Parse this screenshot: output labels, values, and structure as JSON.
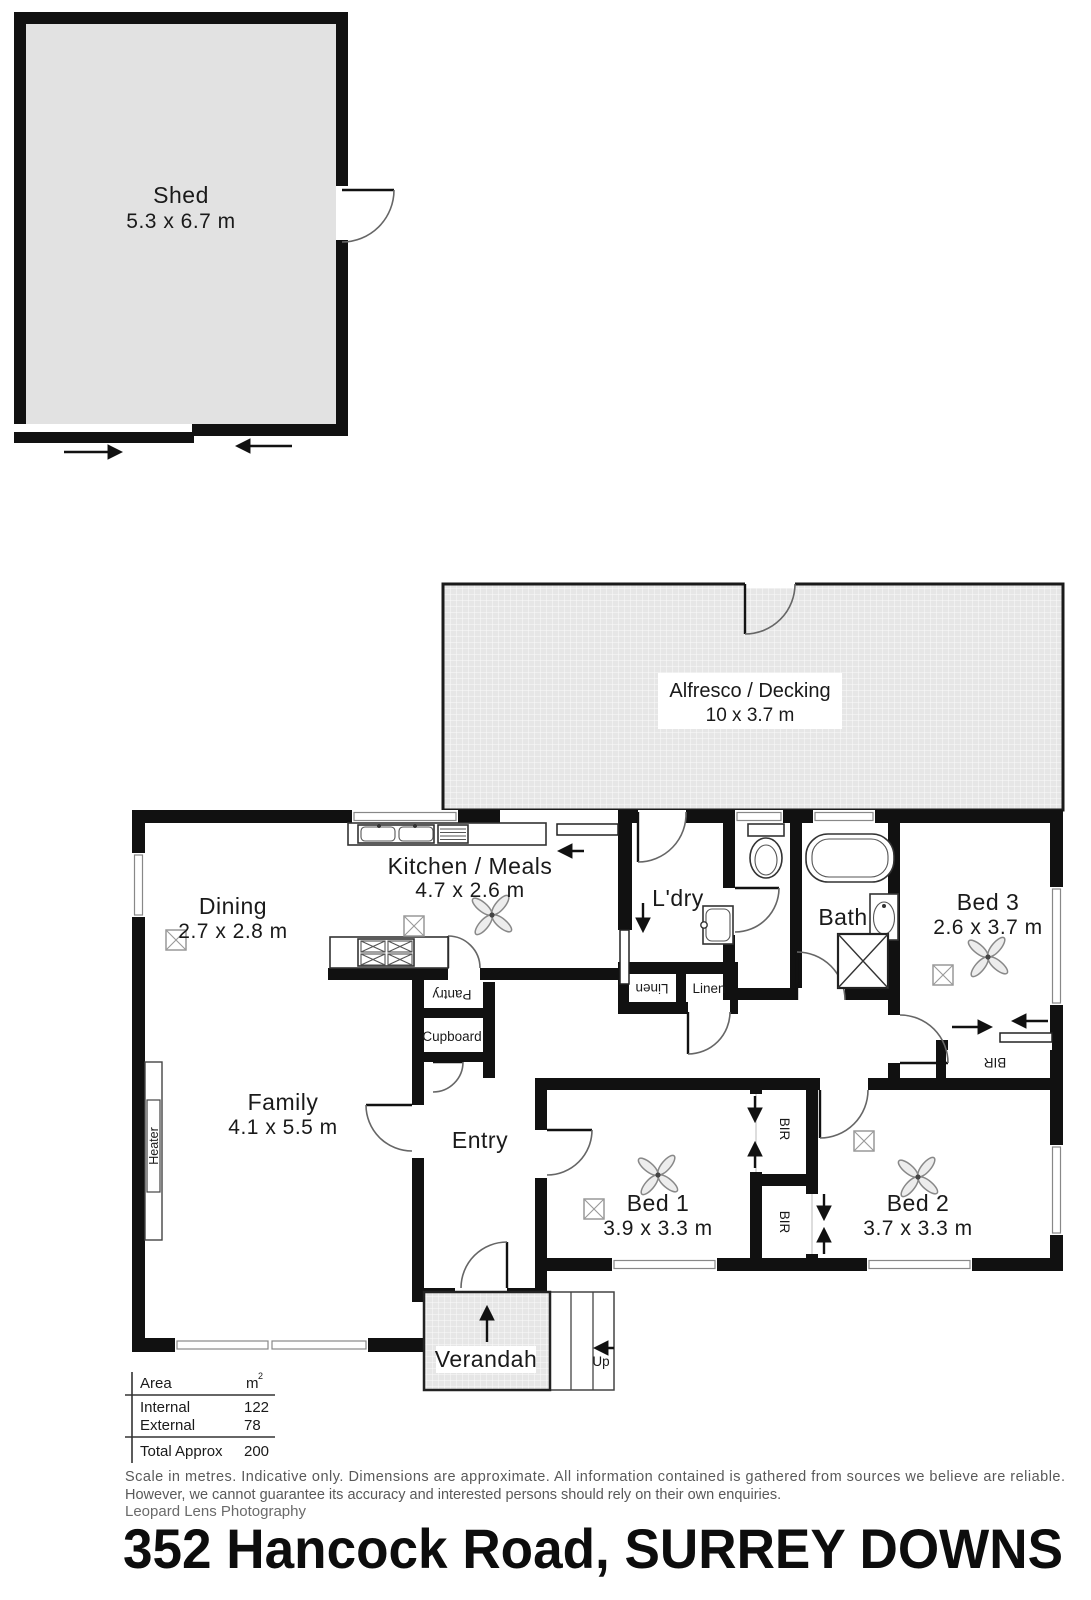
{
  "outbuilding": {
    "shed": {
      "name": "Shed",
      "dims": "5.3 x 6.7 m"
    }
  },
  "alfresco": {
    "name": "Alfresco / Decking",
    "dims": "10 x 3.7 m"
  },
  "rooms": {
    "dining": {
      "name": "Dining",
      "dims": "2.7 x 2.8 m"
    },
    "kitchen": {
      "name": "Kitchen / Meals",
      "dims": "4.7 x 2.6 m"
    },
    "laundry": {
      "name": "L'dry"
    },
    "bath": {
      "name": "Bath"
    },
    "bed3": {
      "name": "Bed 3",
      "dims": "2.6 x 3.7 m"
    },
    "family": {
      "name": "Family",
      "dims": "4.1 x 5.5 m"
    },
    "entry": {
      "name": "Entry"
    },
    "bed1": {
      "name": "Bed 1",
      "dims": "3.9 x 3.3 m"
    },
    "bed2": {
      "name": "Bed 2",
      "dims": "3.7 x 3.3 m"
    },
    "verandah": {
      "name": "Verandah"
    }
  },
  "features": {
    "pantry": "Pantry",
    "cupboard": "Cupboard",
    "linen_left": "Linen",
    "linen_right": "Linen",
    "heater": "Heater",
    "bir_bed1": "BIR",
    "bir_bed2": "BIR",
    "bir_bed3": "BIR",
    "up_label": "Up"
  },
  "area_table": {
    "col_area": "Area",
    "col_unit": "m",
    "unit_sup": "2",
    "rows": [
      {
        "label": "Internal",
        "value": "122"
      },
      {
        "label": "External",
        "value": "78"
      }
    ],
    "total_label": "Total Approx",
    "total_value": "200"
  },
  "footer": {
    "disclaimer_line1": "Scale in metres. Indicative only. Dimensions are approximate. All information contained is gathered from sources we believe are reliable.",
    "disclaimer_line2": "However, we cannot guarantee its accuracy and interested persons should rely on their own enquiries.",
    "credit": "Leopard Lens Photography",
    "address": "352 Hancock Road, SURREY DOWNS"
  },
  "colors": {
    "wall": "#111111",
    "shed_fill": "#e2e2e2",
    "deck_fill": "#e6e6e6",
    "muted_text": "#595959"
  }
}
